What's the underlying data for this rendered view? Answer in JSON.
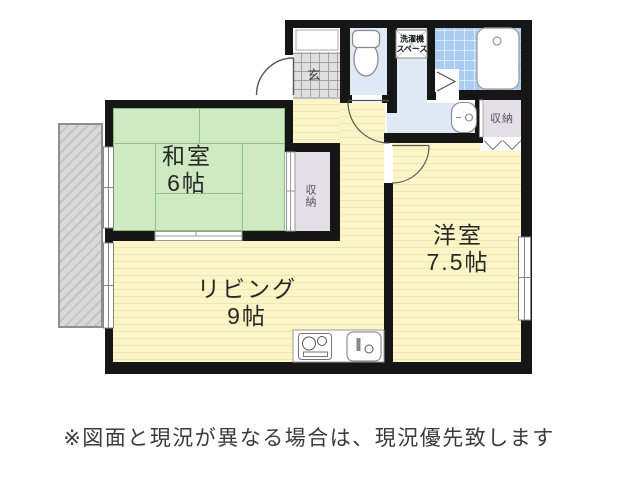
{
  "plan": {
    "rooms": {
      "washitsu": {
        "name": "和室",
        "size": "6帖"
      },
      "living": {
        "name": "リビング",
        "size": "9帖"
      },
      "youshitsu": {
        "name": "洋室",
        "size": "7.5帖"
      },
      "genkan": {
        "label": "玄"
      },
      "closet_hall": {
        "label": "収納"
      },
      "closet_right": {
        "label": "収納"
      },
      "washer": {
        "line1": "洗濯機",
        "line2": "スペース"
      }
    },
    "disclaimer": "※図面と現況が異なる場合は、現況優先致します",
    "colors": {
      "wall": "#161616",
      "tatami": "#cfe9c3",
      "flooring": "#fcf6c6",
      "water_room": "#dfe9f6",
      "bath_tile": "#a9ccf0",
      "closet": "#e4e0ea",
      "balcony": "#d9d9d9"
    }
  }
}
